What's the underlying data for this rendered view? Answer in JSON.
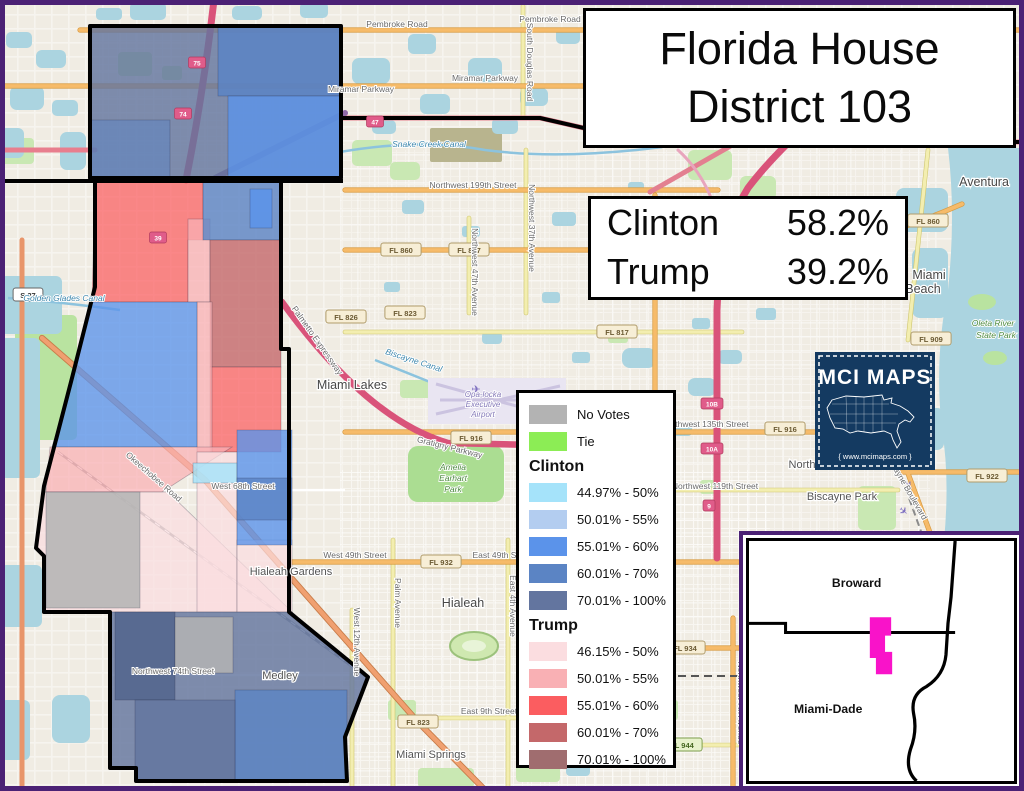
{
  "title": {
    "line1": "Florida House",
    "line2": "District 103"
  },
  "results": {
    "rows": [
      {
        "name": "Clinton",
        "pct": "58.2%"
      },
      {
        "name": "Trump",
        "pct": "39.2%"
      }
    ]
  },
  "legend": {
    "simple": [
      {
        "label": "No Votes",
        "color_key": "GRAY"
      },
      {
        "label": "Tie",
        "color_key": "TIE"
      }
    ],
    "groups": [
      {
        "header": "Clinton",
        "items": [
          {
            "label": "44.97% - 50%",
            "color_key": "C44"
          },
          {
            "label": "50.01% - 55%",
            "color_key": "C50"
          },
          {
            "label": "55.01% - 60%",
            "color_key": "C55"
          },
          {
            "label": "60.01% - 70%",
            "color_key": "C60"
          },
          {
            "label": "70.01% - 100%",
            "color_key": "C70"
          }
        ]
      },
      {
        "header": "Trump",
        "items": [
          {
            "label": "46.15% - 50%",
            "color_key": "T46"
          },
          {
            "label": "50.01% - 55%",
            "color_key": "T50"
          },
          {
            "label": "55.01% - 60%",
            "color_key": "T55"
          },
          {
            "label": "60.01% - 70%",
            "color_key": "T60"
          },
          {
            "label": "70.01% - 100%",
            "color_key": "T70"
          }
        ]
      }
    ]
  },
  "logo": {
    "title": "MCI MAPS",
    "url": "{ www.mcimaps.com }"
  },
  "inset": {
    "county_top": "Broward",
    "county_bottom": "Miami-Dade"
  },
  "map": {
    "labels": [
      {
        "t": "Aventura",
        "x": 984,
        "y": 186,
        "c": "city"
      },
      {
        "t": "Miami",
        "x": 929,
        "y": 279,
        "c": "city"
      },
      {
        "t": "Beach",
        "x": 923,
        "y": 293,
        "c": "city"
      },
      {
        "t": "Miami Lakes",
        "x": 352,
        "y": 389,
        "c": "city"
      },
      {
        "t": "Hialeah",
        "x": 463,
        "y": 607,
        "c": "city"
      },
      {
        "t": "Hialeah Gardens",
        "x": 291,
        "y": 575,
        "c": "city2"
      },
      {
        "t": "Medley",
        "x": 280,
        "y": 679,
        "c": "city2"
      },
      {
        "t": "Miami Springs",
        "x": 431,
        "y": 758,
        "c": "city2"
      },
      {
        "t": "Biscayne Park",
        "x": 842,
        "y": 500,
        "c": "city2"
      },
      {
        "t": "North",
        "x": 802,
        "y": 468,
        "c": "city2"
      },
      {
        "t": "Pembroke Road",
        "x": 397,
        "y": 27,
        "c": "road"
      },
      {
        "t": "Pembroke Road",
        "x": 550,
        "y": 22,
        "c": "road"
      },
      {
        "t": "Miramar Parkway",
        "x": 361,
        "y": 92,
        "c": "road"
      },
      {
        "t": "Miramar Parkway",
        "x": 485,
        "y": 81,
        "c": "road"
      },
      {
        "t": "Northwest 199th Street",
        "x": 473,
        "y": 188,
        "c": "road"
      },
      {
        "t": "Northwest 135th Street",
        "x": 705,
        "y": 427,
        "c": "road"
      },
      {
        "t": "Northwest 119th Street",
        "x": 715,
        "y": 489,
        "c": "road"
      },
      {
        "t": "West 49th Street",
        "x": 355,
        "y": 558,
        "c": "road"
      },
      {
        "t": "East 49th Street",
        "x": 503,
        "y": 558,
        "c": "road"
      },
      {
        "t": "West 68th Street",
        "x": 243,
        "y": 489,
        "c": "road"
      },
      {
        "t": "Northwest 74th Street",
        "x": 173,
        "y": 674,
        "c": "road"
      },
      {
        "t": "East 9th Street",
        "x": 489,
        "y": 714,
        "c": "road"
      },
      {
        "t": "South Douglas Road",
        "x": 527,
        "y": 62,
        "c": "road",
        "r": 90
      },
      {
        "t": "Northwest 37th Avenue",
        "x": 529,
        "y": 228,
        "c": "road",
        "r": 90
      },
      {
        "t": "Northwest 47th Avenue",
        "x": 472,
        "y": 272,
        "c": "road",
        "r": 90
      },
      {
        "t": "Northwest 7th Avenue",
        "x": 738,
        "y": 703,
        "c": "road",
        "r": 90
      },
      {
        "t": "East 4th Avenue",
        "x": 510,
        "y": 606,
        "c": "road",
        "r": 90
      },
      {
        "t": "Palm Avenue",
        "x": 395,
        "y": 603,
        "c": "road",
        "r": 90
      },
      {
        "t": "West 12th Avenue",
        "x": 354,
        "y": 642,
        "c": "road",
        "r": 90
      },
      {
        "t": "Biscayne Boulevard",
        "x": 904,
        "y": 488,
        "c": "road",
        "r": 60
      },
      {
        "t": "Okeechobee Road",
        "x": 152,
        "y": 479,
        "c": "road",
        "r": 41
      },
      {
        "t": "Gratigny Parkway",
        "x": 449,
        "y": 450,
        "c": "road",
        "r": 14
      },
      {
        "t": "Palmetto Expressway",
        "x": 315,
        "y": 342,
        "c": "road",
        "r": 55
      },
      {
        "t": "Snake Creek Canal",
        "x": 429,
        "y": 147,
        "c": "water"
      },
      {
        "t": "Golden Glades Canal",
        "x": 64,
        "y": 301,
        "c": "water"
      },
      {
        "t": "Biscayne Canal",
        "x": 413,
        "y": 363,
        "c": "water",
        "r": 18
      },
      {
        "t": "Oleta River",
        "x": 993,
        "y": 326,
        "c": "park"
      },
      {
        "t": "State Park",
        "x": 996,
        "y": 338,
        "c": "park"
      },
      {
        "t": "Amelia",
        "x": 453,
        "y": 470,
        "c": "park"
      },
      {
        "t": "Earhart",
        "x": 453,
        "y": 481,
        "c": "park"
      },
      {
        "t": "Park",
        "x": 453,
        "y": 492,
        "c": "park"
      },
      {
        "t": "Opa-locka",
        "x": 483,
        "y": 397,
        "c": "air"
      },
      {
        "t": "Executive",
        "x": 483,
        "y": 407,
        "c": "air"
      },
      {
        "t": "Airport",
        "x": 483,
        "y": 417,
        "c": "air"
      }
    ],
    "shields": [
      {
        "t": "FL 860",
        "x": 401,
        "y": 250,
        "k": "fl"
      },
      {
        "t": "FL 847",
        "x": 469,
        "y": 250,
        "k": "fl"
      },
      {
        "t": "FL 860",
        "x": 928,
        "y": 221,
        "k": "fl"
      },
      {
        "t": "FL 823",
        "x": 405,
        "y": 313,
        "k": "fl"
      },
      {
        "t": "FL 817",
        "x": 617,
        "y": 332,
        "k": "fl"
      },
      {
        "t": "FL 826",
        "x": 346,
        "y": 317,
        "k": "fl"
      },
      {
        "t": "FL 916",
        "x": 471,
        "y": 438,
        "k": "fl"
      },
      {
        "t": "FL 916",
        "x": 785,
        "y": 429,
        "k": "fl"
      },
      {
        "t": "FL 909",
        "x": 931,
        "y": 339,
        "k": "fl"
      },
      {
        "t": "FL 922",
        "x": 987,
        "y": 476,
        "k": "fl"
      },
      {
        "t": "FL 932",
        "x": 441,
        "y": 562,
        "k": "fl"
      },
      {
        "t": "FL 934",
        "x": 685,
        "y": 648,
        "k": "fl"
      },
      {
        "t": "FL 944",
        "x": 682,
        "y": 745,
        "k": "grn"
      },
      {
        "t": "FL 823",
        "x": 418,
        "y": 722,
        "k": "fl"
      },
      {
        "t": "US 441",
        "x": 745,
        "y": 137,
        "k": "us"
      },
      {
        "t": "S 27",
        "x": 28,
        "y": 295,
        "k": "us"
      }
    ],
    "exits": [
      {
        "t": "75",
        "x": 197,
        "y": 63
      },
      {
        "t": "74",
        "x": 183,
        "y": 114
      },
      {
        "t": "47",
        "x": 375,
        "y": 122
      },
      {
        "t": "39",
        "x": 158,
        "y": 238
      },
      {
        "t": "10B",
        "x": 712,
        "y": 404
      },
      {
        "t": "10A",
        "x": 712,
        "y": 449
      },
      {
        "t": "9",
        "x": 709,
        "y": 506
      }
    ],
    "planes": [
      {
        "x": 476,
        "y": 393,
        "r": 0
      },
      {
        "x": 906,
        "y": 488,
        "r": 40
      },
      {
        "x": 901,
        "y": 514,
        "r": 40
      }
    ]
  },
  "colors": {
    "GRAY": "#b3b3b3",
    "TIE": "#8ced55",
    "C44": "#a5e3fa",
    "C50": "#b3cdf0",
    "C55": "#5b93ea",
    "C60": "#5b84c4",
    "C70": "#63759f",
    "C70D": "#51648c",
    "T46": "#fbdde0",
    "T50": "#f9b0b4",
    "T55": "#fb5d60",
    "T60": "#c4686a",
    "T70": "#a06d6f",
    "MAGENTA": "#f913c9",
    "NAVY": "#143a61",
    "PURPLE": "#4b2175"
  }
}
